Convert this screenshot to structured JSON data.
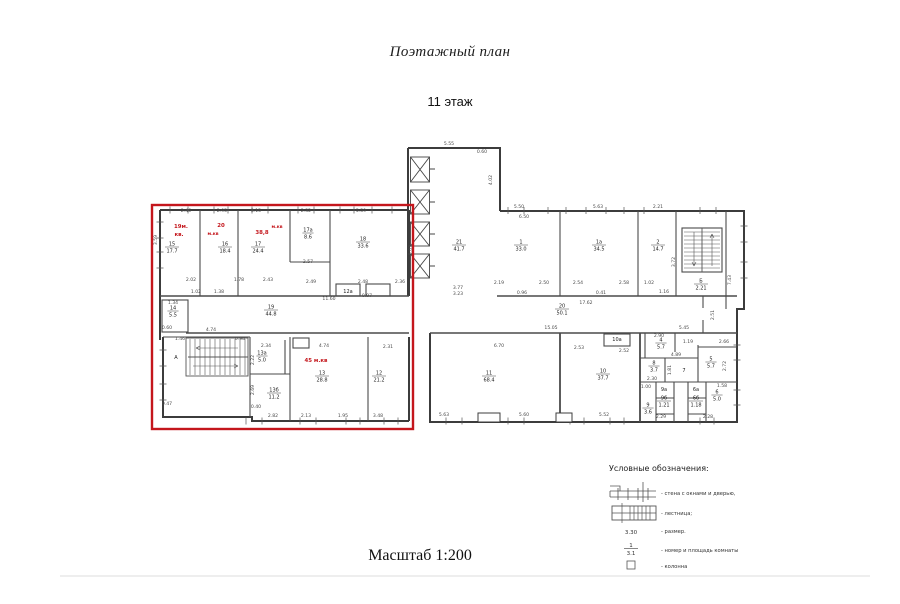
{
  "page": {
    "title": "Поэтажный план",
    "floor_label": "11 этаж",
    "scale_label": "Масштаб 1:200"
  },
  "colors": {
    "highlight_red": "#c4161c",
    "wall": "#3c3c3c"
  },
  "plan": {
    "apartments": [
      {
        "l1": "19м.",
        "l2": "кв."
      },
      {
        "l1": "20",
        "l2": "м.кв"
      },
      {
        "l1": "38,8",
        "l2": "м.кв"
      },
      {
        "l1": "45 м.кв",
        "l2": ""
      }
    ],
    "rooms": [
      {
        "num": "15",
        "area": "17.7"
      },
      {
        "num": "16",
        "area": "18.4"
      },
      {
        "num": "17",
        "area": "24.4"
      },
      {
        "num": "17а",
        "area": "8.6"
      },
      {
        "num": "18",
        "area": "33.6"
      },
      {
        "num": "14",
        "area": "5.5"
      },
      {
        "num": "19",
        "area": "44.8"
      },
      {
        "num": "13а",
        "area": "5.0"
      },
      {
        "num": "13б",
        "area": "11.2"
      },
      {
        "num": "13",
        "area": "28.8"
      },
      {
        "num": "12",
        "area": "21.2"
      },
      {
        "num": "21",
        "area": "41.7"
      },
      {
        "num": "1",
        "area": "33.0"
      },
      {
        "num": "1а",
        "area": "34.5"
      },
      {
        "num": "2",
        "area": "14.7"
      },
      {
        "num": "Б",
        "area": "2.21"
      },
      {
        "num": "20",
        "area": "50.1"
      },
      {
        "num": "11",
        "area": "68.4"
      },
      {
        "num": "10",
        "area": "37.7"
      },
      {
        "num": "4",
        "area": "5.7"
      },
      {
        "num": "8",
        "area": "3.7"
      },
      {
        "num": "5",
        "area": "5.7"
      },
      {
        "num": "9б",
        "area": "1.21"
      },
      {
        "num": "9",
        "area": "3.6"
      },
      {
        "num": "6б",
        "area": "1.18"
      },
      {
        "num": "6",
        "area": "5.0"
      }
    ],
    "marks": [
      "7",
      "9а",
      "6а",
      "10а",
      "12а",
      "А"
    ],
    "dims": [
      "2.46",
      "2.95",
      "3.15",
      "2.32",
      "5.59",
      "3.59",
      "2.02",
      "1.78",
      "2.43",
      "2.57",
      "1.02",
      "1.38",
      "2.49",
      "2.48",
      "2.36",
      "0.97",
      "11.60",
      "1.34",
      "0.60",
      "4.74",
      "1.46",
      "0.98",
      "2.34",
      "2.22",
      "2.69",
      "0.40",
      "2.82",
      "4.74",
      "2.31",
      "2.13",
      "1.95",
      "3.48",
      "5.55",
      "0.60",
      "4.02",
      "6.50",
      "3.77",
      "3.23",
      "5.50",
      "5.63",
      "2.21",
      "2.19",
      "2.50",
      "2.54",
      "2.58",
      "1.02",
      "0.96",
      "0.41",
      "17.62",
      "1.16",
      "15.05",
      "5.45",
      "2.51",
      "6.70",
      "2.53",
      "2.52",
      "2.90",
      "1.19",
      "2.66",
      "4.89",
      "1.81",
      "2.72",
      "2.30",
      "1.00",
      "1.58",
      "2.29",
      "2.28",
      "5.63",
      "5.60",
      "5.52",
      "3.72",
      "7.43",
      "0.47",
      "5.03"
    ]
  },
  "legend": {
    "title": "Условные обозначения:",
    "items": [
      {
        "label": "- стена с окнами и дверью,"
      },
      {
        "label": "- лестница;"
      },
      {
        "value": "3.30",
        "label": "- размер."
      },
      {
        "num": "1",
        "area": "3.1",
        "label": "- номер и площадь комнаты"
      },
      {
        "label": "- колонна"
      }
    ]
  }
}
